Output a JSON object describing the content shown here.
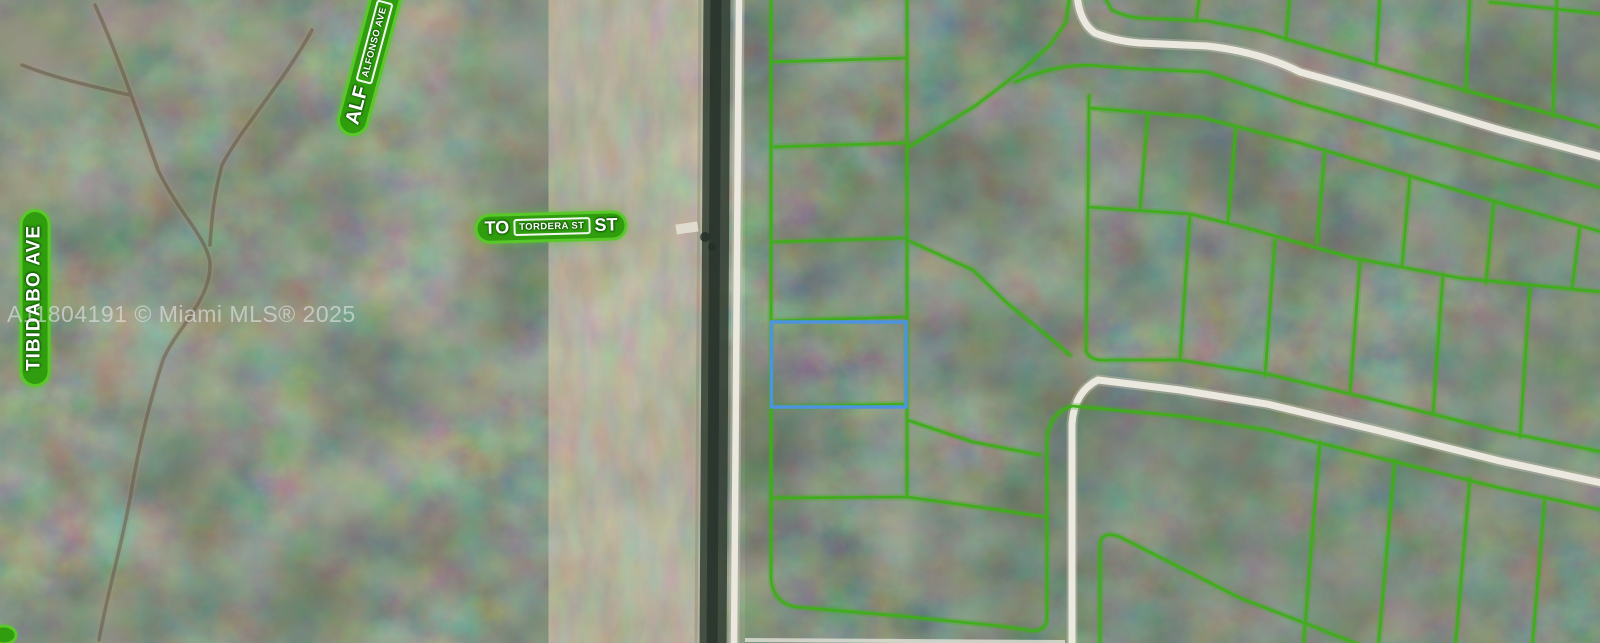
{
  "map": {
    "watermark": "A11804191 © Miami MLS® 2025",
    "street_labels": {
      "tibidabo": {
        "text": "TIBIDABO AVE"
      },
      "alfonso": {
        "abbrev": "ALF",
        "full": "ALFONSO AVE"
      },
      "tordera": {
        "prefix": "TO",
        "full": "TORDERA ST",
        "suffix": "ST"
      }
    },
    "colors": {
      "parcel_line": "#3fae1a",
      "label_fill": "#2f9d0e",
      "label_halo": "#58c928",
      "subject_parcel": "#4e93e0",
      "road": "#eae8df",
      "canal": "#323e33",
      "forest": "#45523f",
      "dirt": "#988f72",
      "watermark": "rgba(228,228,228,0.62)"
    }
  }
}
